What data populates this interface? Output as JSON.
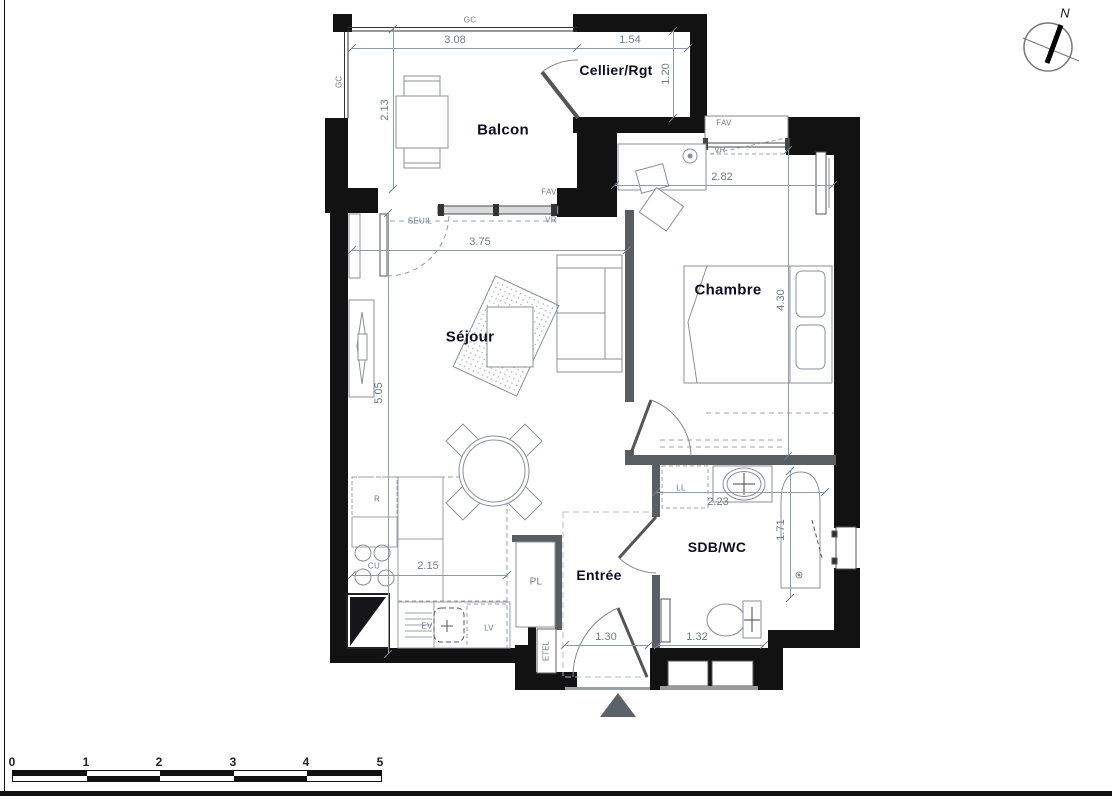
{
  "rooms": {
    "balcon": "Balcon",
    "cellier": "Cellier/Rgt",
    "chambre": "Chambre",
    "sejour": "Séjour",
    "entree": "Entrée",
    "sdb": "SDB/WC"
  },
  "dims": {
    "balcony_width": "3.08",
    "cellier_width": "1.54",
    "balcony_depth": "2.13",
    "cellier_depth": "1.20",
    "chambre_width": "2.82",
    "chambre_depth": "4.30",
    "sejour_width": "3.75",
    "sejour_depth": "5.05",
    "kitchen_run": "2.15",
    "sdb_width": "2.23",
    "bath_length": "1.71",
    "entry_door": "1.30",
    "sdb_run": "1.32"
  },
  "tags": {
    "gc_top": "GC",
    "gc_left": "GC",
    "fav_sejour": "FAV",
    "vr_sejour": "VR",
    "seuil": "SEUIL",
    "fav_chambre": "FAV",
    "vr_chambre": "VR",
    "fridge": "R",
    "hob": "CU",
    "sink": "EV",
    "dishwasher": "LV",
    "closet": "PL",
    "elec_panel": "ETEL",
    "washer": "LL"
  },
  "compass": {
    "north": "N"
  },
  "scale_bar": {
    "ticks": [
      "0",
      "1",
      "2",
      "3",
      "4",
      "5"
    ]
  },
  "colors": {
    "wall": "#121212",
    "partition": "#5a5e63",
    "outline": "#8a9099",
    "dim_text": "#6b7b8b",
    "room_text": "#0d0d24"
  }
}
